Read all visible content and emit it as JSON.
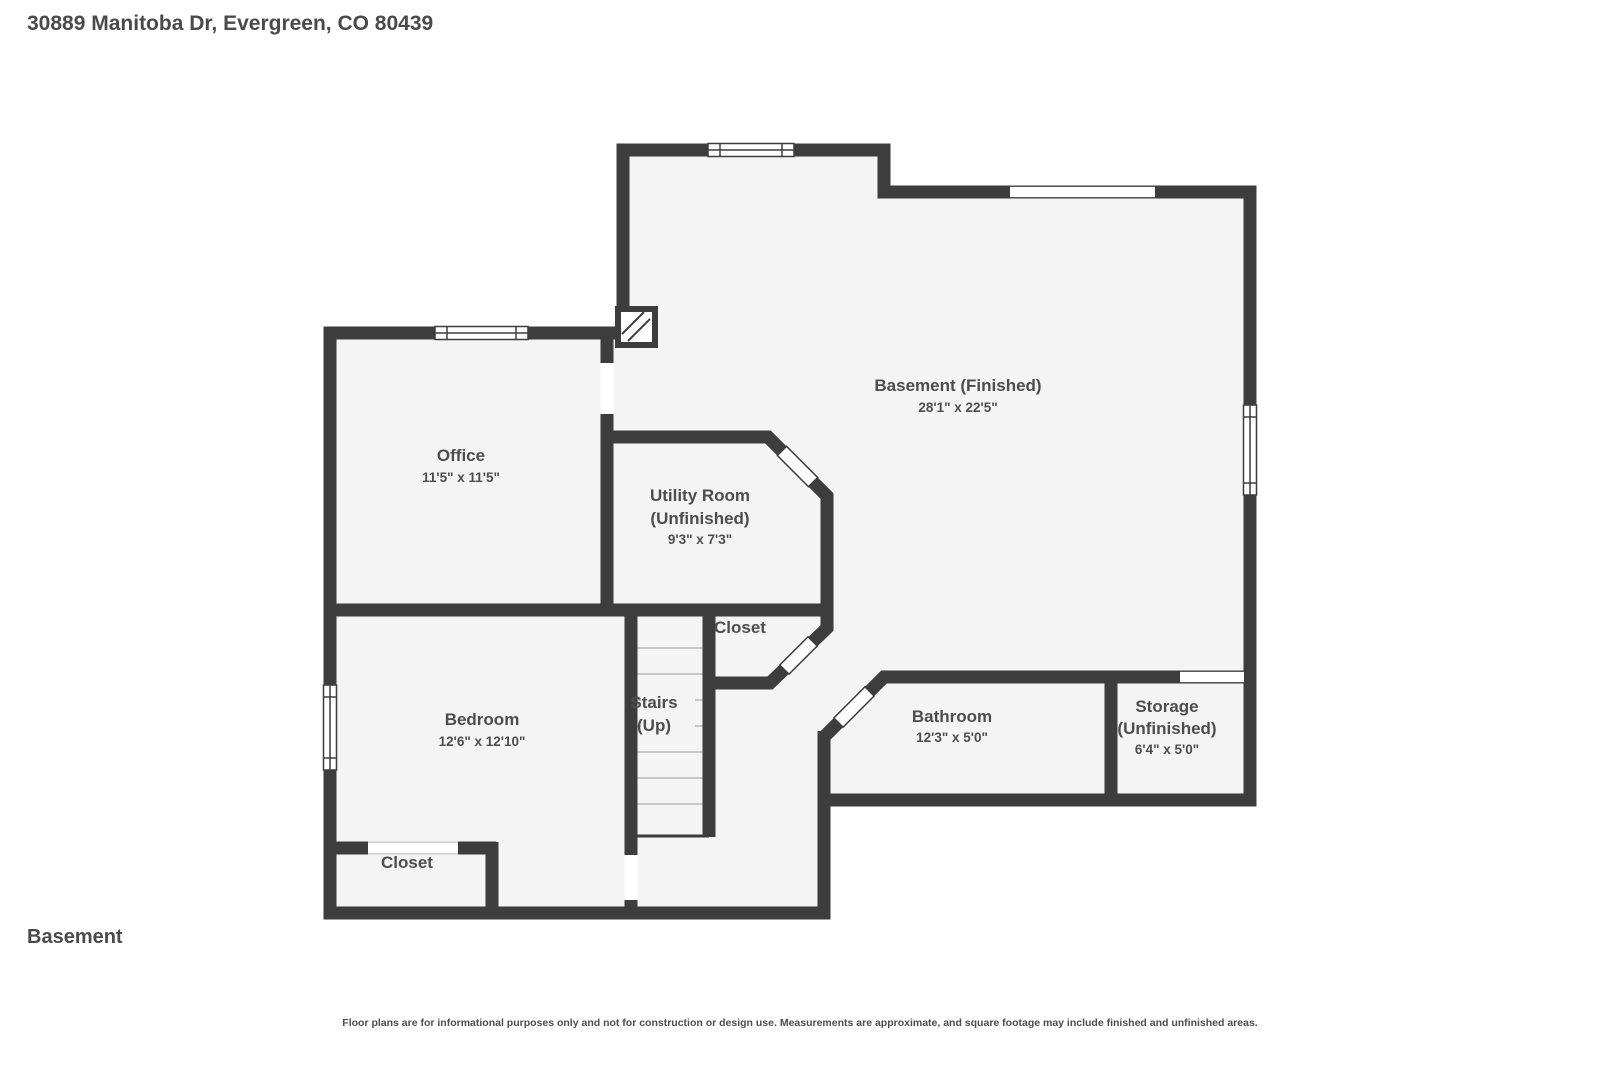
{
  "header": {
    "address": "30889 Manitoba Dr, Evergreen, CO 80439"
  },
  "floor": {
    "label": "Basement"
  },
  "footer": {
    "disclaimer": "Floor plans are for informational purposes only and not for construction or design use. Measurements are approximate, and square footage may include finished and unfinished areas."
  },
  "colors": {
    "wall": "#3d3d3d",
    "floor": "#f4f4f4",
    "text": "#4d4d4d",
    "step_line": "#b9b9b9"
  },
  "rooms": {
    "basement": {
      "name": "Basement (Finished)",
      "dims": "28'1\" x 22'5\""
    },
    "office": {
      "name": "Office",
      "dims": "11'5\" x 11'5\""
    },
    "utility": {
      "name1": "Utility Room",
      "name2": "(Unfinished)",
      "dims": "9'3\" x 7'3\""
    },
    "closet_hall": {
      "name": "Closet"
    },
    "stairs": {
      "name1": "Stairs",
      "name2": "(Up)"
    },
    "bedroom": {
      "name": "Bedroom",
      "dims": "12'6\" x 12'10\""
    },
    "bathroom": {
      "name": "Bathroom",
      "dims": "12'3\" x 5'0\""
    },
    "storage": {
      "name1": "Storage",
      "name2": "(Unfinished)",
      "dims": "6'4\" x 5'0\""
    },
    "closet_bedroom": {
      "name": "Closet"
    }
  }
}
